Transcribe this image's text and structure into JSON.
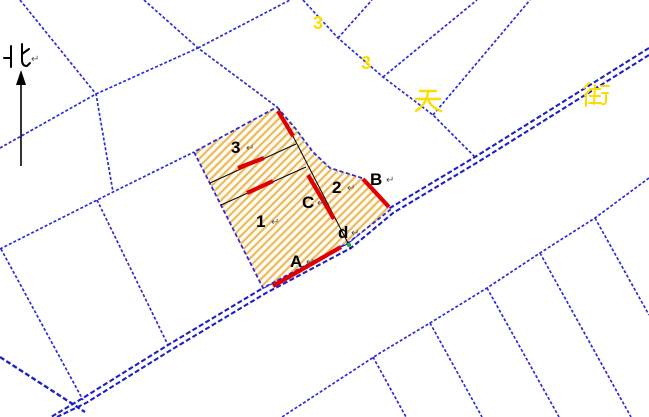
{
  "map": {
    "north_indicator": {
      "label": "北",
      "paragraph_mark": "↵"
    },
    "street_labels": {
      "glyph1": "3",
      "glyph2": "3",
      "glyph3": "天",
      "glyph4": "街"
    },
    "subject_parcel": {
      "region_labels": {
        "r1": "1",
        "r2": "2",
        "r3": "3"
      },
      "point_labels": {
        "a": "A",
        "b": "B",
        "c": "C",
        "d": "d"
      },
      "paragraph_mark": "↵"
    },
    "colors": {
      "parcel_line_blue": "#2c2cd6",
      "road_line_blue": "#1f1fc8",
      "highlight_red": "#e00000",
      "hatch_stripe": "#ecb964",
      "hatch_background": "#fffdf2",
      "street_label_yellow": "#fddd00",
      "survey_line_black": "#000000",
      "marker_green": "#2ea44f"
    }
  }
}
